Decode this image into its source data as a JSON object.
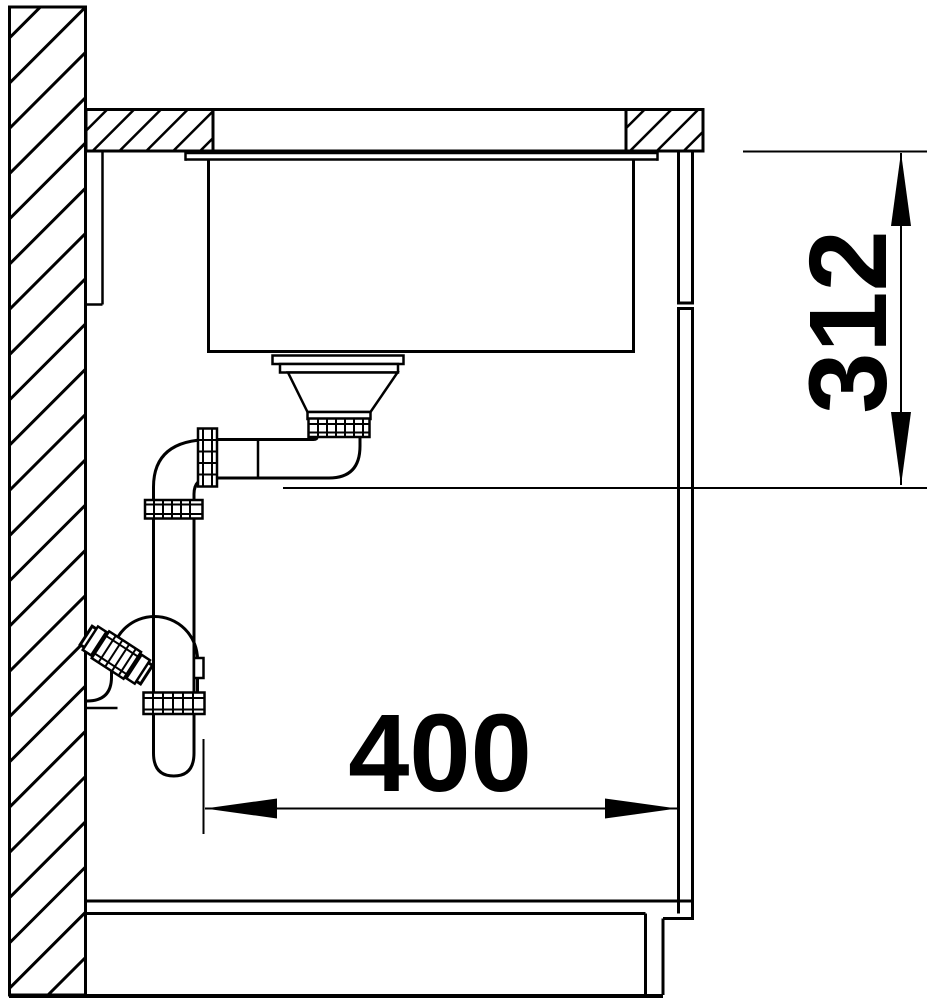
{
  "drawing": {
    "colors": {
      "line": "#000000",
      "background": "#ffffff"
    },
    "dimensions": {
      "depth": {
        "label": "400"
      },
      "height": {
        "label": "312"
      }
    }
  }
}
